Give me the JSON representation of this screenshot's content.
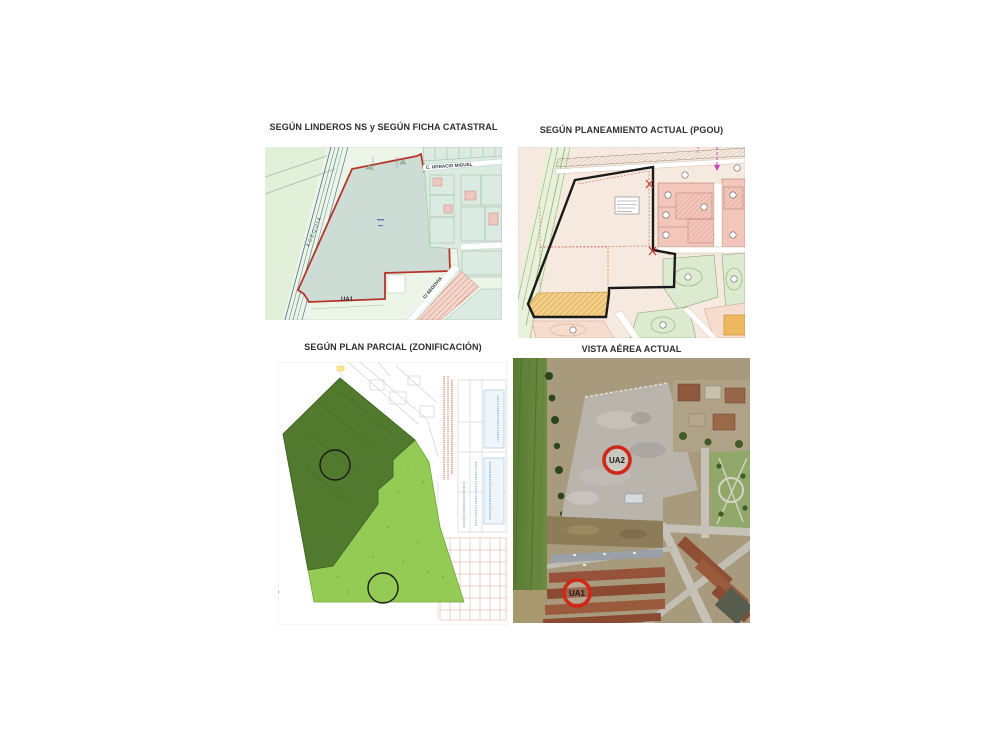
{
  "colors": {
    "accent_red": "#b5352a",
    "boundary_black": "#1a1a1a",
    "badge_ring_red": "#d02818",
    "zone_dark_green": "#517a2e",
    "zone_light_green": "#93cb55",
    "catastral_parcel_fill": "#cddcd4",
    "pgou_background": "#f8ece3",
    "pgou_orange": "#eec26a"
  },
  "panels": {
    "catastral": {
      "title": "SEGÚN LINDEROS NS y SEGÚN FICHA CATASTRAL",
      "street_top": "C. HORACIO MIGUEL",
      "road_label": "ACEQUIA",
      "street_right": "C/ SEGOVIA",
      "zone_label": "UA1"
    },
    "pgou": {
      "title": "SEGÚN PLANEAMIENTO ACTUAL (PGOU)"
    },
    "plan_parcial": {
      "title": "SEGÚN PLAN PARCIAL (ZONIFICACIÓN)"
    },
    "aerea": {
      "title": "VISTA AÉREA ACTUAL",
      "ua2_label": "UA2",
      "ua1_label": "UA1"
    }
  }
}
